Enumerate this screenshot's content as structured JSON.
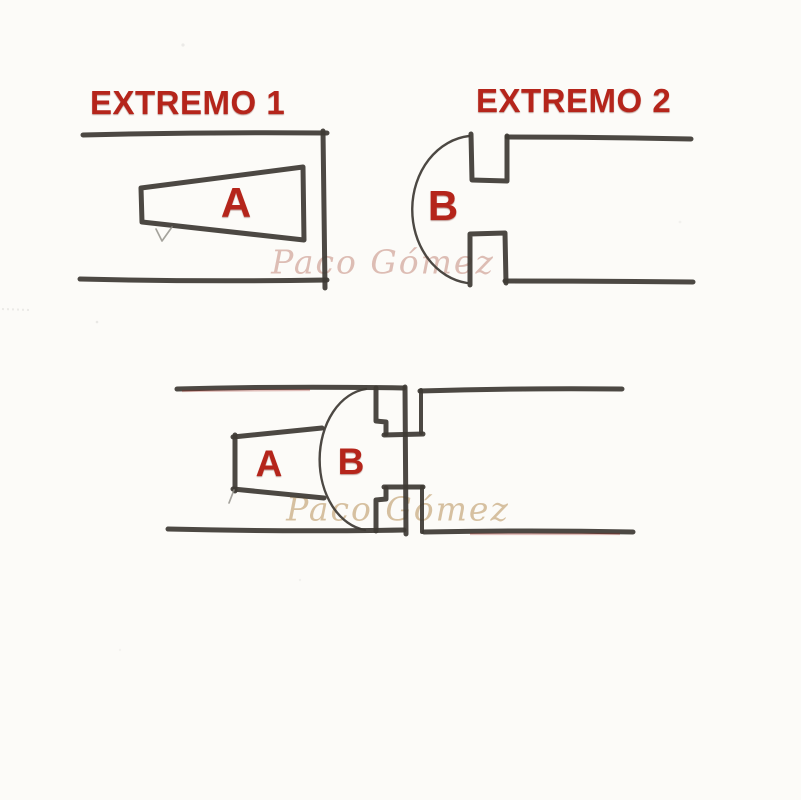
{
  "title_labels": {
    "extremo1": "EXTREMO 1",
    "extremo2": "EXTREMO 2"
  },
  "parts": {
    "top_a": "A",
    "top_b": "B",
    "assembled_a": "A",
    "assembled_b": "B"
  },
  "watermarks": {
    "top": "Paco Gómez",
    "bottom": "Paco Gómez"
  },
  "colors": {
    "label_red": "#b5251b",
    "pencil_dark": "#3e3a35",
    "watermark_pink": "#c9968a",
    "watermark_tan": "#c4a376",
    "paper": "#fcfbf8"
  }
}
